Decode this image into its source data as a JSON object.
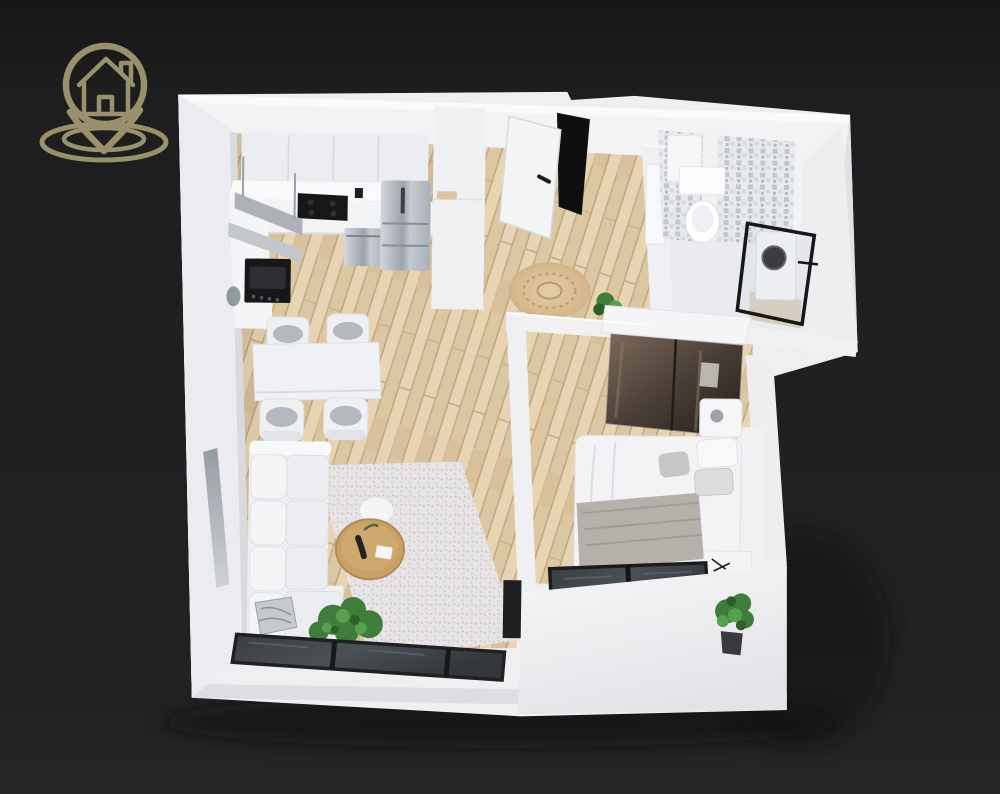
{
  "canvas": {
    "width": 1000,
    "height": 794,
    "background": "#1f1f20"
  },
  "logo": {
    "icon": "house-location-pin-icon",
    "color": "#98916c"
  },
  "floor_plan": {
    "style": "3d-isometric-apartment-render",
    "colors": {
      "walls": "#f2f2f4",
      "wood_floor": "#dcc7a3",
      "bathroom_floor": "#e9ebee",
      "window_frames": "#1e1f22",
      "wardrobe_glass": "#4a3f36",
      "plants": "#3f7d3a",
      "rug_living": "#e7e4e5",
      "rug_hall_jute": "#d9bd92",
      "appliance_steel": "#aeb4bc"
    },
    "rooms": [
      {
        "name": "kitchen"
      },
      {
        "name": "dining-area"
      },
      {
        "name": "living-room"
      },
      {
        "name": "hallway"
      },
      {
        "name": "bathroom"
      },
      {
        "name": "bedroom"
      },
      {
        "name": "balcony-slab"
      }
    ],
    "objects": [
      "upper-cabinets",
      "range-shelf",
      "cooktop",
      "oven",
      "dishwasher",
      "fridge",
      "tall-cabinet",
      "counter-decor",
      "dining-table",
      "dining-chairs",
      "sofa",
      "decor-pillow",
      "area-rug",
      "coffee-table",
      "side-table",
      "floor-plant",
      "living-window-wall",
      "left-wall-window",
      "entrance-door",
      "round-jute-rug",
      "hall-plant",
      "bathroom-tiles",
      "bathroom-cabinet",
      "toilet",
      "bathroom-door",
      "glass-partition",
      "washing-machine",
      "wardrobe",
      "double-bed",
      "throw-blanket",
      "pillows",
      "nightstand",
      "bedroom-bench",
      "bedroom-window-wall",
      "bedroom-plant"
    ]
  }
}
